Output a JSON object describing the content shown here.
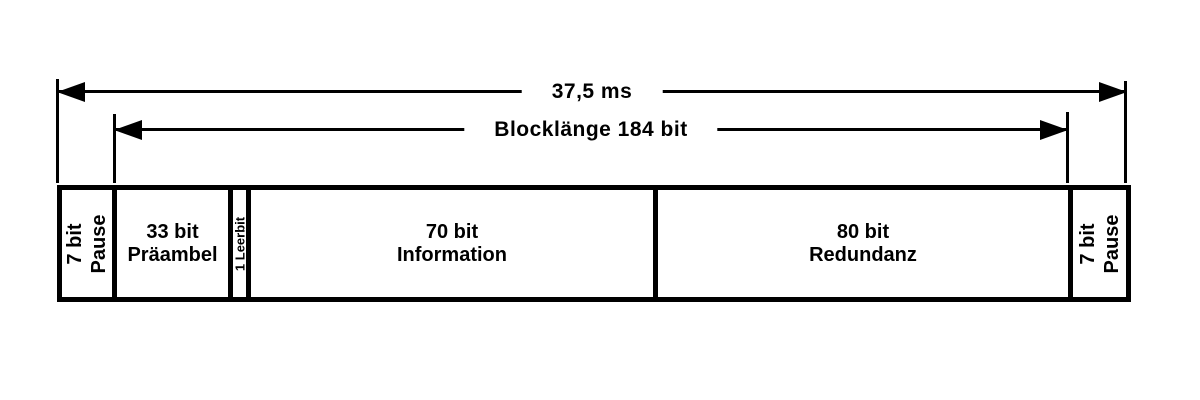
{
  "diagram": {
    "dimensions": {
      "total": {
        "label": "37,5 ms"
      },
      "block": {
        "label": "Blocklänge 184 bit"
      }
    },
    "segments": [
      {
        "id": "pause-left",
        "line1": "7 bit",
        "line2": "Pause",
        "orientation": "rotated",
        "bits": 7
      },
      {
        "id": "praeambel",
        "line1": "33 bit",
        "line2": "Präambel",
        "orientation": "horizontal",
        "bits": 33
      },
      {
        "id": "leerbit",
        "line1": "1 Leerbit",
        "orientation": "rotated",
        "bits": 1
      },
      {
        "id": "information",
        "line1": "70 bit",
        "line2": "Information",
        "orientation": "horizontal",
        "bits": 70
      },
      {
        "id": "redundanz",
        "line1": "80 bit",
        "line2": "Redundanz",
        "orientation": "horizontal",
        "bits": 80
      },
      {
        "id": "pause-right",
        "line1": "7 bit",
        "line2": "Pause",
        "orientation": "rotated",
        "bits": 7
      }
    ],
    "colors": {
      "foreground": "#000000",
      "background": "#ffffff"
    }
  }
}
